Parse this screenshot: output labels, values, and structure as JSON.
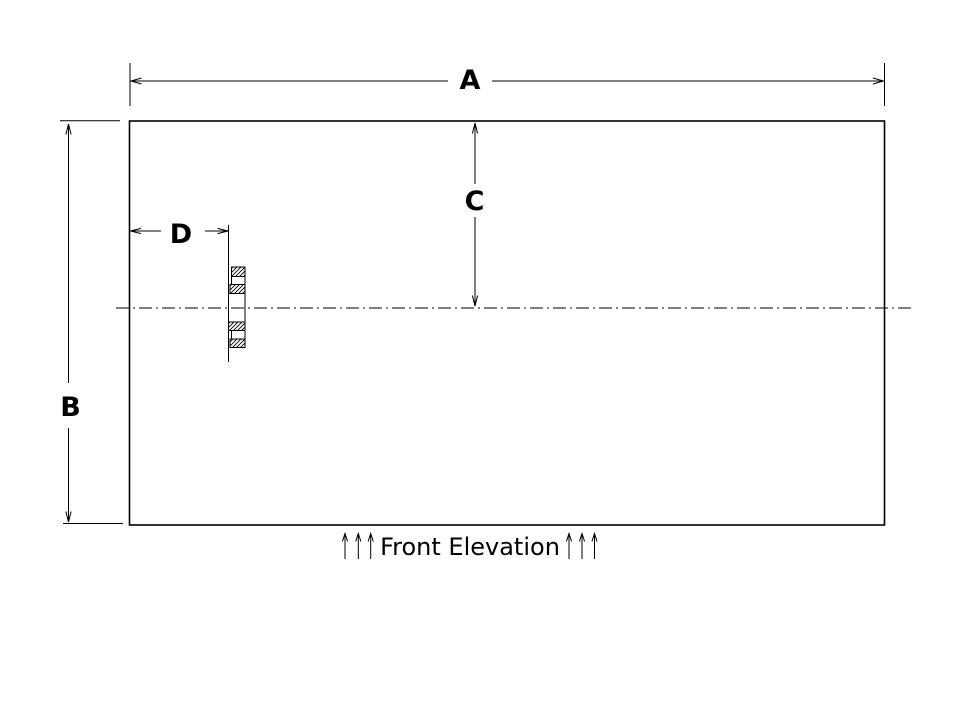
{
  "colors": {
    "ink": "#000000",
    "paper": "#ffffff"
  },
  "view_title": "Front Elevation",
  "dimension_labels": {
    "a": "A",
    "b": "B",
    "c": "C",
    "d": "D"
  }
}
